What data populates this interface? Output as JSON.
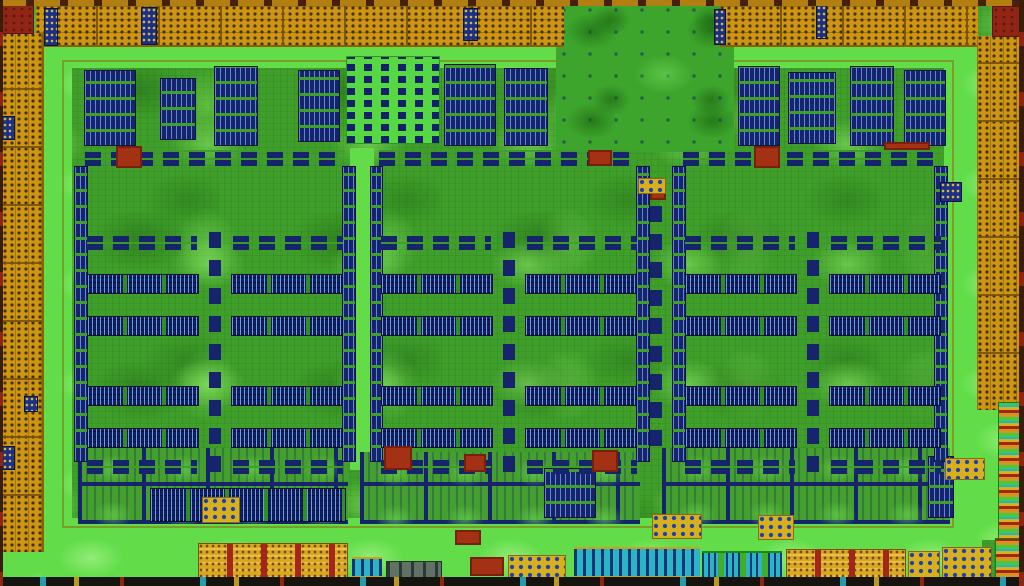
{
  "meta": {
    "description": "false-color die photograph of a GPU chip",
    "width": 1024,
    "height": 586
  },
  "palette": {
    "base": "#3f9f2a",
    "moat": "#62dd49",
    "navy": "#15246b",
    "blueLt": "#7db2ff",
    "orange": "#cd9512",
    "gold": "#d9a81e",
    "redBar": "#a3261a",
    "red": "#a33214",
    "maroon": "#8f2615",
    "cyan": "#2ab4c6",
    "chip": "#d8b01e",
    "edge": "#16140f"
  },
  "regions": [
    {
      "n": "die-substrate",
      "t": "gbase",
      "r": [
        0,
        0,
        1024,
        586
      ]
    },
    {
      "n": "moat-top",
      "t": "moat",
      "r": [
        38,
        44,
        944,
        24
      ]
    },
    {
      "n": "moat-left",
      "t": "moat",
      "r": [
        42,
        44,
        30,
        510
      ]
    },
    {
      "n": "moat-bottom",
      "t": "moat",
      "r": [
        42,
        518,
        940,
        62
      ]
    },
    {
      "n": "moat-right",
      "t": "moat",
      "r": [
        944,
        44,
        38,
        484
      ]
    },
    {
      "n": "moat-corner-bl",
      "t": "moat",
      "r": [
        2,
        550,
        40,
        30
      ]
    },
    {
      "n": "moat-right-low",
      "t": "moat",
      "r": [
        958,
        400,
        64,
        140
      ]
    },
    {
      "n": "core-frame",
      "t": "frame",
      "r": [
        62,
        60,
        892,
        468
      ]
    },
    {
      "n": "forest-top-mid",
      "t": "forest",
      "r": [
        556,
        4,
        178,
        148
      ]
    },
    {
      "n": "dense-logic-block",
      "t": "dense",
      "r": [
        346,
        56,
        94,
        88
      ]
    },
    {
      "n": "sram-patch",
      "t": "bgv",
      "r": [
        84,
        70,
        52,
        76
      ]
    },
    {
      "n": "sram-patch",
      "t": "bgv",
      "r": [
        160,
        78,
        36,
        62
      ]
    },
    {
      "n": "sram-patch",
      "t": "bgv",
      "r": [
        214,
        66,
        44,
        80
      ]
    },
    {
      "n": "sram-patch",
      "t": "bgv",
      "r": [
        298,
        70,
        42,
        72
      ]
    },
    {
      "n": "sram-patch",
      "t": "bgv",
      "r": [
        444,
        64,
        52,
        82
      ]
    },
    {
      "n": "sram-patch",
      "t": "bgv",
      "r": [
        504,
        68,
        44,
        78
      ]
    },
    {
      "n": "sram-patch",
      "t": "bgv",
      "r": [
        738,
        66,
        42,
        80
      ]
    },
    {
      "n": "sram-patch",
      "t": "bgv",
      "r": [
        788,
        72,
        48,
        72
      ]
    },
    {
      "n": "sram-patch",
      "t": "bgv",
      "r": [
        850,
        66,
        44,
        80
      ]
    },
    {
      "n": "sram-patch",
      "t": "bgv",
      "r": [
        904,
        70,
        42,
        76
      ]
    },
    {
      "n": "vertical-channel",
      "t": "moat",
      "r": [
        350,
        148,
        24,
        322
      ]
    },
    {
      "n": "center-chain",
      "t": "chain",
      "r": [
        648,
        194,
        14,
        252
      ]
    },
    {
      "n": "tile-fabric-left",
      "t": "tiles",
      "r": [
        78,
        448,
        270,
        76
      ]
    },
    {
      "n": "tile-fabric-mid",
      "t": "tiles",
      "r": [
        360,
        452,
        280,
        72
      ]
    },
    {
      "n": "tile-fabric-right",
      "t": "tiles",
      "r": [
        662,
        448,
        288,
        76
      ]
    },
    {
      "n": "sram-band",
      "t": "ladder",
      "r": [
        150,
        488,
        196,
        34
      ]
    },
    {
      "n": "sram-patch",
      "t": "bgv",
      "r": [
        544,
        468,
        52,
        50
      ]
    },
    {
      "n": "sram-patch",
      "t": "bgv",
      "r": [
        928,
        456,
        26,
        62
      ]
    },
    {
      "n": "sm-dash-row",
      "t": "dash",
      "r": [
        85,
        150,
        260,
        16
      ]
    },
    {
      "n": "sm-edge-col",
      "t": "bgv",
      "r": [
        74,
        166,
        14,
        296
      ]
    },
    {
      "n": "sm-edge-col",
      "t": "bgv",
      "r": [
        342,
        166,
        14,
        296
      ]
    },
    {
      "n": "sm-dash-row",
      "t": "dash",
      "r": [
        87,
        236,
        110,
        14
      ]
    },
    {
      "n": "sm-dash-row",
      "t": "dash",
      "r": [
        233,
        236,
        110,
        14
      ]
    },
    {
      "n": "register-ladder",
      "t": "ladder",
      "r": [
        87,
        274,
        112,
        20
      ]
    },
    {
      "n": "register-ladder",
      "t": "ladder",
      "r": [
        231,
        274,
        112,
        20
      ]
    },
    {
      "n": "register-ladder",
      "t": "ladder",
      "r": [
        87,
        316,
        112,
        20
      ]
    },
    {
      "n": "register-ladder",
      "t": "ladder",
      "r": [
        231,
        316,
        112,
        20
      ]
    },
    {
      "n": "register-ladder",
      "t": "ladder",
      "r": [
        87,
        386,
        112,
        20
      ]
    },
    {
      "n": "register-ladder",
      "t": "ladder",
      "r": [
        231,
        386,
        112,
        20
      ]
    },
    {
      "n": "register-ladder",
      "t": "ladder",
      "r": [
        87,
        428,
        112,
        20
      ]
    },
    {
      "n": "register-ladder",
      "t": "ladder",
      "r": [
        231,
        428,
        112,
        20
      ]
    },
    {
      "n": "gpc-spine",
      "t": "chain",
      "r": [
        209,
        226,
        12,
        246
      ]
    },
    {
      "n": "sm-dash-row",
      "t": "dash",
      "r": [
        87,
        460,
        110,
        14
      ]
    },
    {
      "n": "sm-dash-row",
      "t": "dash",
      "r": [
        233,
        460,
        110,
        14
      ]
    },
    {
      "n": "sm-dash-row",
      "t": "dash",
      "r": [
        379,
        150,
        260,
        16
      ]
    },
    {
      "n": "sm-edge-col",
      "t": "bgv",
      "r": [
        370,
        166,
        13,
        296
      ]
    },
    {
      "n": "sm-edge-col",
      "t": "bgv",
      "r": [
        636,
        166,
        14,
        296
      ]
    },
    {
      "n": "sm-dash-row",
      "t": "dash",
      "r": [
        381,
        236,
        110,
        14
      ]
    },
    {
      "n": "sm-dash-row",
      "t": "dash",
      "r": [
        527,
        236,
        110,
        14
      ]
    },
    {
      "n": "register-ladder",
      "t": "ladder",
      "r": [
        381,
        274,
        112,
        20
      ]
    },
    {
      "n": "register-ladder",
      "t": "ladder",
      "r": [
        525,
        274,
        112,
        20
      ]
    },
    {
      "n": "register-ladder",
      "t": "ladder",
      "r": [
        381,
        316,
        112,
        20
      ]
    },
    {
      "n": "register-ladder",
      "t": "ladder",
      "r": [
        525,
        316,
        112,
        20
      ]
    },
    {
      "n": "register-ladder",
      "t": "ladder",
      "r": [
        381,
        386,
        112,
        20
      ]
    },
    {
      "n": "register-ladder",
      "t": "ladder",
      "r": [
        525,
        386,
        112,
        20
      ]
    },
    {
      "n": "register-ladder",
      "t": "ladder",
      "r": [
        381,
        428,
        112,
        20
      ]
    },
    {
      "n": "register-ladder",
      "t": "ladder",
      "r": [
        525,
        428,
        112,
        20
      ]
    },
    {
      "n": "gpc-spine",
      "t": "chain",
      "r": [
        503,
        226,
        12,
        246
      ]
    },
    {
      "n": "sm-dash-row",
      "t": "dash",
      "r": [
        381,
        460,
        110,
        14
      ]
    },
    {
      "n": "sm-dash-row",
      "t": "dash",
      "r": [
        527,
        460,
        110,
        14
      ]
    },
    {
      "n": "sm-dash-row",
      "t": "dash",
      "r": [
        683,
        150,
        260,
        16
      ]
    },
    {
      "n": "sm-edge-col",
      "t": "bgv",
      "r": [
        672,
        166,
        14,
        296
      ]
    },
    {
      "n": "sm-edge-col",
      "t": "bgv",
      "r": [
        934,
        166,
        14,
        296
      ]
    },
    {
      "n": "sm-dash-row",
      "t": "dash",
      "r": [
        685,
        236,
        110,
        14
      ]
    },
    {
      "n": "sm-dash-row",
      "t": "dash",
      "r": [
        831,
        236,
        110,
        14
      ]
    },
    {
      "n": "register-ladder",
      "t": "ladder",
      "r": [
        685,
        274,
        112,
        20
      ]
    },
    {
      "n": "register-ladder",
      "t": "ladder",
      "r": [
        829,
        274,
        112,
        20
      ]
    },
    {
      "n": "register-ladder",
      "t": "ladder",
      "r": [
        685,
        316,
        112,
        20
      ]
    },
    {
      "n": "register-ladder",
      "t": "ladder",
      "r": [
        829,
        316,
        112,
        20
      ]
    },
    {
      "n": "register-ladder",
      "t": "ladder",
      "r": [
        685,
        386,
        112,
        20
      ]
    },
    {
      "n": "register-ladder",
      "t": "ladder",
      "r": [
        829,
        386,
        112,
        20
      ]
    },
    {
      "n": "register-ladder",
      "t": "ladder",
      "r": [
        685,
        428,
        112,
        20
      ]
    },
    {
      "n": "register-ladder",
      "t": "ladder",
      "r": [
        829,
        428,
        112,
        20
      ]
    },
    {
      "n": "gpc-spine",
      "t": "chain",
      "r": [
        807,
        226,
        12,
        246
      ]
    },
    {
      "n": "sm-dash-row",
      "t": "dash",
      "r": [
        685,
        460,
        110,
        14
      ]
    },
    {
      "n": "sm-dash-row",
      "t": "dash",
      "r": [
        831,
        460,
        110,
        14
      ]
    },
    {
      "n": "red-block",
      "t": "red",
      "r": [
        116,
        146,
        26,
        22
      ]
    },
    {
      "n": "red-block",
      "t": "red",
      "r": [
        754,
        146,
        26,
        22
      ]
    },
    {
      "n": "red-block",
      "t": "red",
      "r": [
        384,
        446,
        28,
        24
      ]
    },
    {
      "n": "red-block",
      "t": "red",
      "r": [
        592,
        450,
        26,
        22
      ]
    },
    {
      "n": "red-block",
      "t": "red",
      "r": [
        464,
        454,
        22,
        18
      ]
    },
    {
      "n": "red-block",
      "t": "red",
      "r": [
        650,
        186,
        16,
        14
      ]
    },
    {
      "n": "red-block",
      "t": "red",
      "r": [
        588,
        150,
        24,
        16
      ]
    },
    {
      "n": "red-bar",
      "t": "red",
      "r": [
        884,
        142,
        46,
        8
      ]
    },
    {
      "n": "fuse-block",
      "t": "chip",
      "r": [
        202,
        497,
        38,
        26
      ]
    },
    {
      "n": "fuse-block",
      "t": "chip",
      "r": [
        638,
        178,
        28,
        16
      ]
    },
    {
      "n": "fuse-block",
      "t": "chip",
      "r": [
        652,
        514,
        50,
        25
      ]
    },
    {
      "n": "fuse-block",
      "t": "chip",
      "r": [
        758,
        515,
        36,
        25
      ]
    },
    {
      "n": "fuse-block",
      "t": "chip",
      "r": [
        945,
        458,
        40,
        22
      ]
    },
    {
      "n": "io-pad-band-top-left",
      "t": "pad",
      "r": [
        36,
        5,
        528,
        42
      ]
    },
    {
      "n": "io-pad-band-top-right",
      "t": "pad",
      "r": [
        720,
        5,
        258,
        42
      ]
    },
    {
      "n": "io-pad-col-left",
      "t": "padv",
      "r": [
        2,
        33,
        42,
        519
      ]
    },
    {
      "n": "io-pad-col-right",
      "t": "padv",
      "r": [
        977,
        36,
        45,
        374
      ]
    },
    {
      "n": "io-stripe-col-right",
      "t": "finestripes",
      "r": [
        998,
        402,
        24,
        144
      ]
    },
    {
      "n": "corner-block-tl",
      "t": "maroon",
      "r": [
        2,
        5,
        32,
        29
      ]
    },
    {
      "n": "corner-block-tr",
      "t": "maroon",
      "r": [
        992,
        6,
        30,
        31
      ]
    },
    {
      "n": "pad-marker",
      "t": "bluemark",
      "r": [
        44,
        8,
        14,
        38
      ]
    },
    {
      "n": "pad-marker",
      "t": "bluemark",
      "r": [
        141,
        7,
        16,
        38
      ]
    },
    {
      "n": "pad-marker",
      "t": "bluemark",
      "r": [
        463,
        8,
        15,
        33
      ]
    },
    {
      "n": "pad-marker",
      "t": "bluemark",
      "r": [
        714,
        9,
        12,
        36
      ]
    },
    {
      "n": "pad-marker",
      "t": "bluemark",
      "r": [
        816,
        5,
        11,
        34
      ]
    },
    {
      "n": "pad-marker",
      "t": "bluemark",
      "r": [
        2,
        116,
        13,
        24
      ]
    },
    {
      "n": "pad-marker",
      "t": "bluemark",
      "r": [
        2,
        446,
        13,
        24
      ]
    },
    {
      "n": "pad-marker",
      "t": "bluemark",
      "r": [
        24,
        396,
        14,
        16
      ]
    },
    {
      "n": "pad-marker",
      "t": "bluemark",
      "r": [
        940,
        182,
        22,
        20
      ]
    },
    {
      "n": "dram-pads-left",
      "t": "goldred",
      "r": [
        198,
        543,
        150,
        36
      ]
    },
    {
      "n": "phy-cyan-small",
      "t": "cyan",
      "r": [
        352,
        557,
        30,
        21
      ]
    },
    {
      "n": "grey-cell-row",
      "t": "grey",
      "r": [
        386,
        561,
        56,
        17
      ]
    },
    {
      "n": "red-block",
      "t": "red",
      "r": [
        455,
        530,
        26,
        15
      ]
    },
    {
      "n": "red-block",
      "t": "red",
      "r": [
        470,
        557,
        34,
        19
      ]
    },
    {
      "n": "fuse-block",
      "t": "chip",
      "r": [
        508,
        555,
        58,
        23
      ]
    },
    {
      "n": "phy-cyan-large",
      "t": "cyan",
      "r": [
        574,
        547,
        126,
        31
      ]
    },
    {
      "n": "phy-cyan-green",
      "t": "cyan2",
      "r": [
        702,
        551,
        80,
        27
      ]
    },
    {
      "n": "dram-pads-right",
      "t": "goldred",
      "r": [
        786,
        549,
        120,
        29
      ]
    },
    {
      "n": "fuse-block",
      "t": "chip",
      "r": [
        908,
        551,
        32,
        27
      ]
    },
    {
      "n": "fuse-block",
      "t": "chip",
      "r": [
        942,
        547,
        50,
        31
      ]
    },
    {
      "n": "corner-stack",
      "t": "finestripes",
      "r": [
        995,
        538,
        27,
        40
      ]
    },
    {
      "n": "die-edge-top",
      "t": "edgetop",
      "r": [
        0,
        0,
        1024,
        6
      ]
    },
    {
      "n": "die-edge-bottom",
      "t": "edgebot",
      "r": [
        0,
        577,
        1024,
        9
      ]
    },
    {
      "n": "die-edge-left",
      "t": "edgeside",
      "r": [
        0,
        0,
        3,
        586
      ]
    },
    {
      "n": "die-edge-right",
      "t": "edgeside",
      "r": [
        1019,
        0,
        5,
        586
      ]
    }
  ]
}
